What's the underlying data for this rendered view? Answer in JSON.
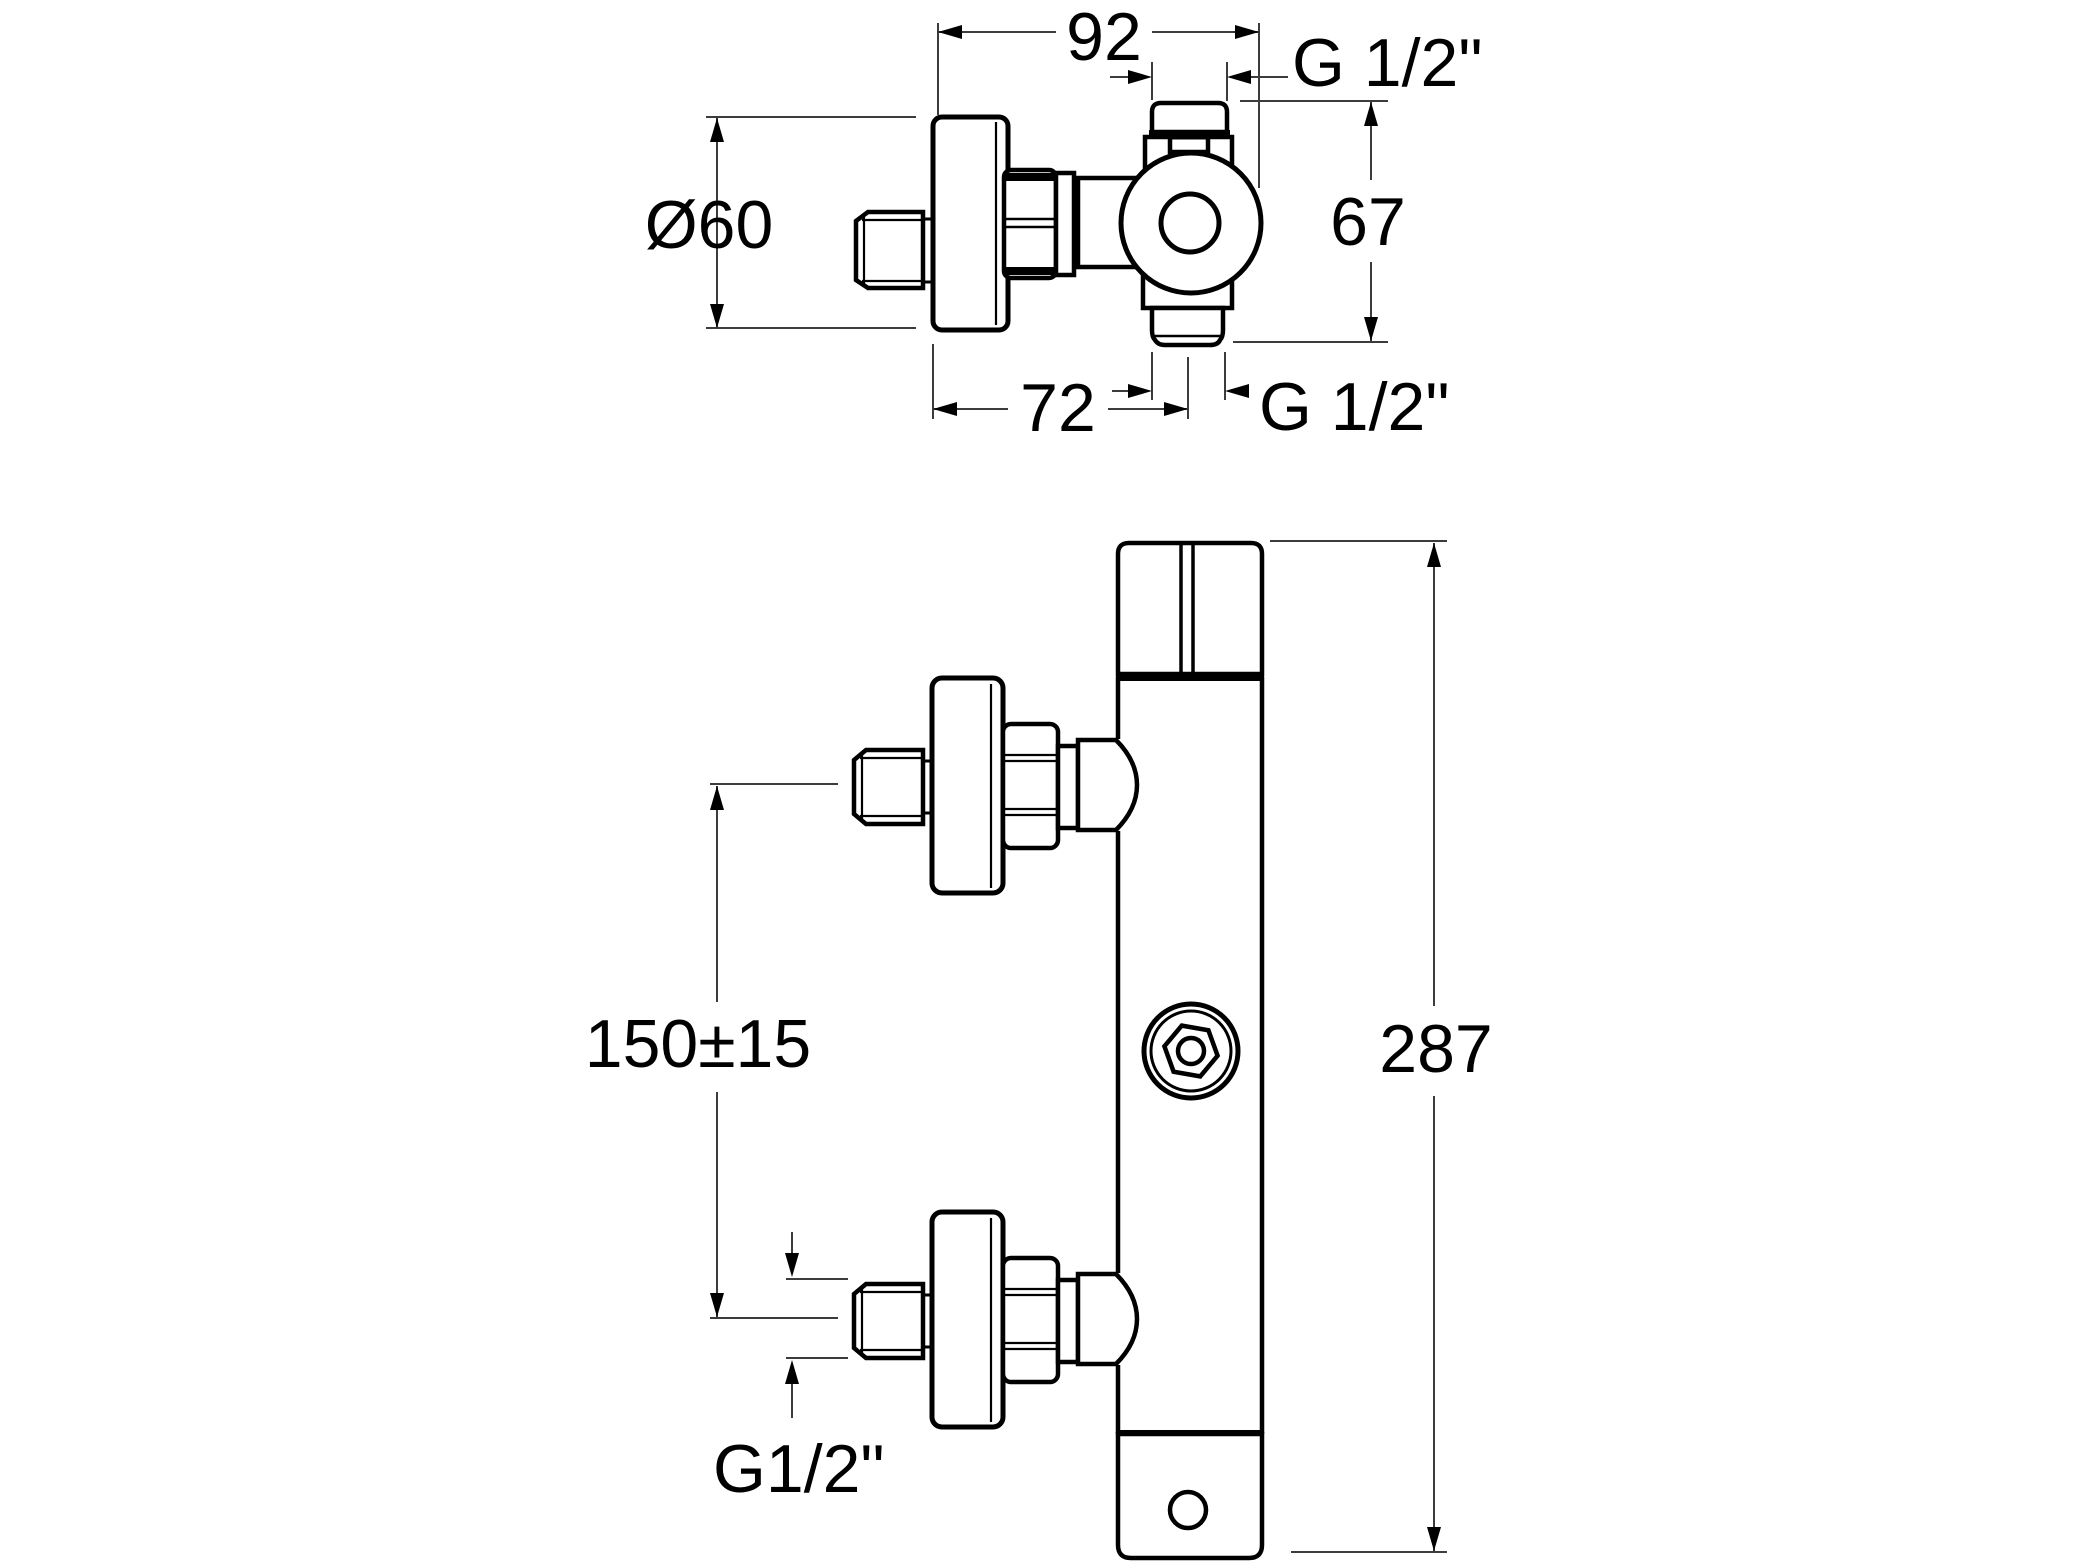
{
  "drawing": {
    "type": "technical-dimension-drawing",
    "subject": "wall-mounted thermostatic shower mixer valve",
    "colors": {
      "background": "#ffffff",
      "outline": "#000000",
      "dimension_line": "#3c3c3c",
      "text": "#000000"
    },
    "views": {
      "top_view": {
        "dimensions": {
          "total_depth": "92",
          "top_thread": "G 1/2\"",
          "flange_diameter": "Ø60",
          "body_height": "67",
          "wall_to_outlet_axis": "72",
          "bottom_thread": "G 1/2\""
        }
      },
      "front_view": {
        "dimensions": {
          "inlet_centre_spacing": "150±15",
          "total_height": "287",
          "inlet_thread": "G1/2\""
        }
      }
    }
  }
}
